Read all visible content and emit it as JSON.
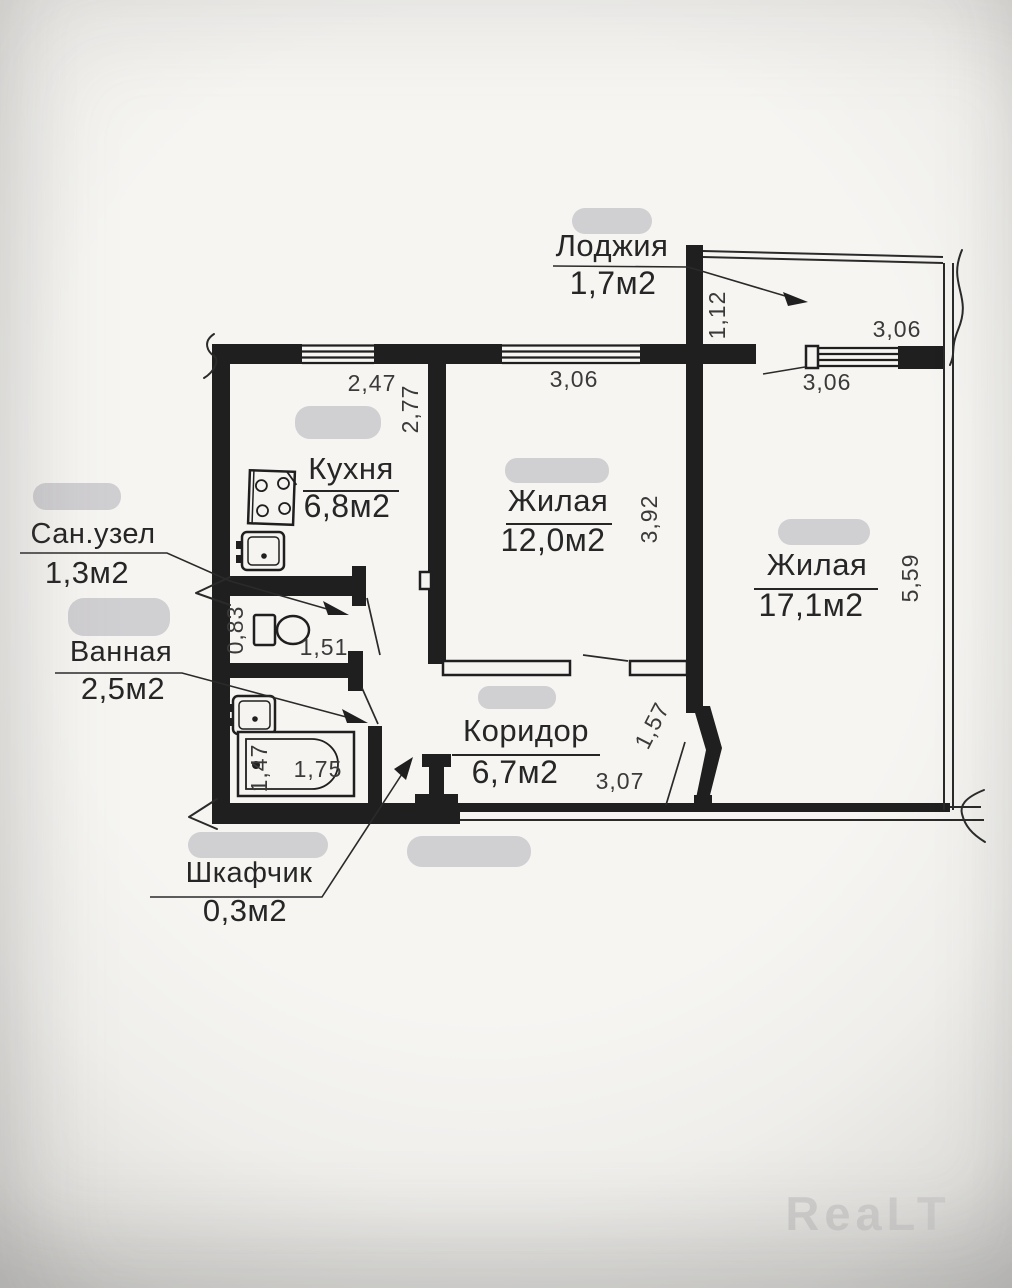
{
  "rooms": {
    "loggia": {
      "label": "Лоджия",
      "area": "1,7м2"
    },
    "kitchen": {
      "label": "Кухня",
      "area": "6,8м2"
    },
    "living1": {
      "label": "Жилая",
      "area": "12,0м2"
    },
    "living2": {
      "label": "Жилая",
      "area": "17,1м2"
    },
    "wc": {
      "label": "Сан.узел",
      "area": "1,3м2"
    },
    "bathroom": {
      "label": "Ванная",
      "area": "2,5м2"
    },
    "corridor": {
      "label": "Коридор",
      "area": "6,7м2"
    },
    "closet": {
      "label": "Шкафчик",
      "area": "0,3м2"
    }
  },
  "dimensions": {
    "kitchen_top": "2,47",
    "kitchen_left": "2,77",
    "living1_top": "3,06",
    "loggia_top": "3,06",
    "loggia_window": "3,06",
    "loggia_depth": "1,12",
    "living1_right": "3,92",
    "living2_right": "5,59",
    "wc_left": "0,83",
    "wc_bottom": "1,51",
    "bath_left": "1,47",
    "bath_bottom": "1,75",
    "corridor_diag": "1,57",
    "corridor_bottom": "3,07"
  },
  "watermark": "ReaLT",
  "colors": {
    "ink": "#1f1f1f",
    "paper": "#f5f4f1",
    "redaction": "#c7c7ca",
    "watermark": "#d0cfce"
  }
}
